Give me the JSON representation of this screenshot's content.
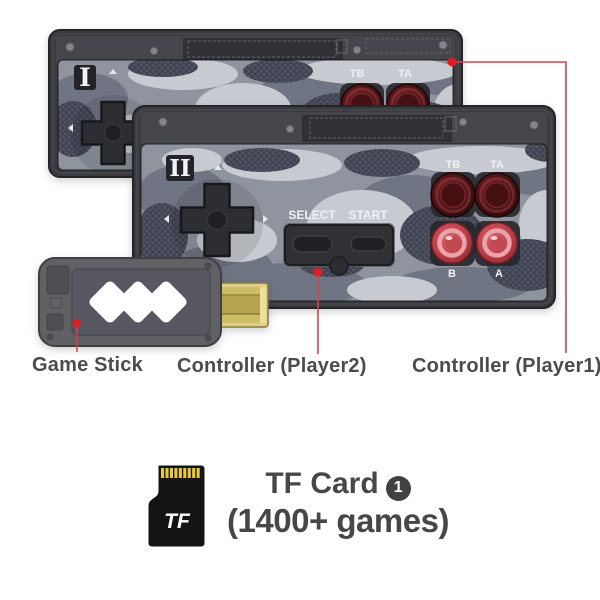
{
  "page": {
    "background": "#ffffff"
  },
  "annotation": {
    "dot_color": "#e01b24",
    "line_color": "#d2434b"
  },
  "devices": {
    "controller_player1": {
      "marker": "I",
      "button_tb": "TB",
      "button_ta": "TA"
    },
    "controller_player2": {
      "marker": "II",
      "button_tb": "TB",
      "button_ta": "TA",
      "select": "SELECT",
      "start": "START",
      "button_b": "B",
      "button_a": "A"
    }
  },
  "callouts": {
    "game_stick": "Game Stick",
    "controller_player2": "Controller (Player2)",
    "controller_player1": "Controller (Player1)"
  },
  "tf_card": {
    "icon_label": "TF",
    "title": "TF Card",
    "badge_number": "1",
    "subtitle": "(1400+ games)"
  }
}
